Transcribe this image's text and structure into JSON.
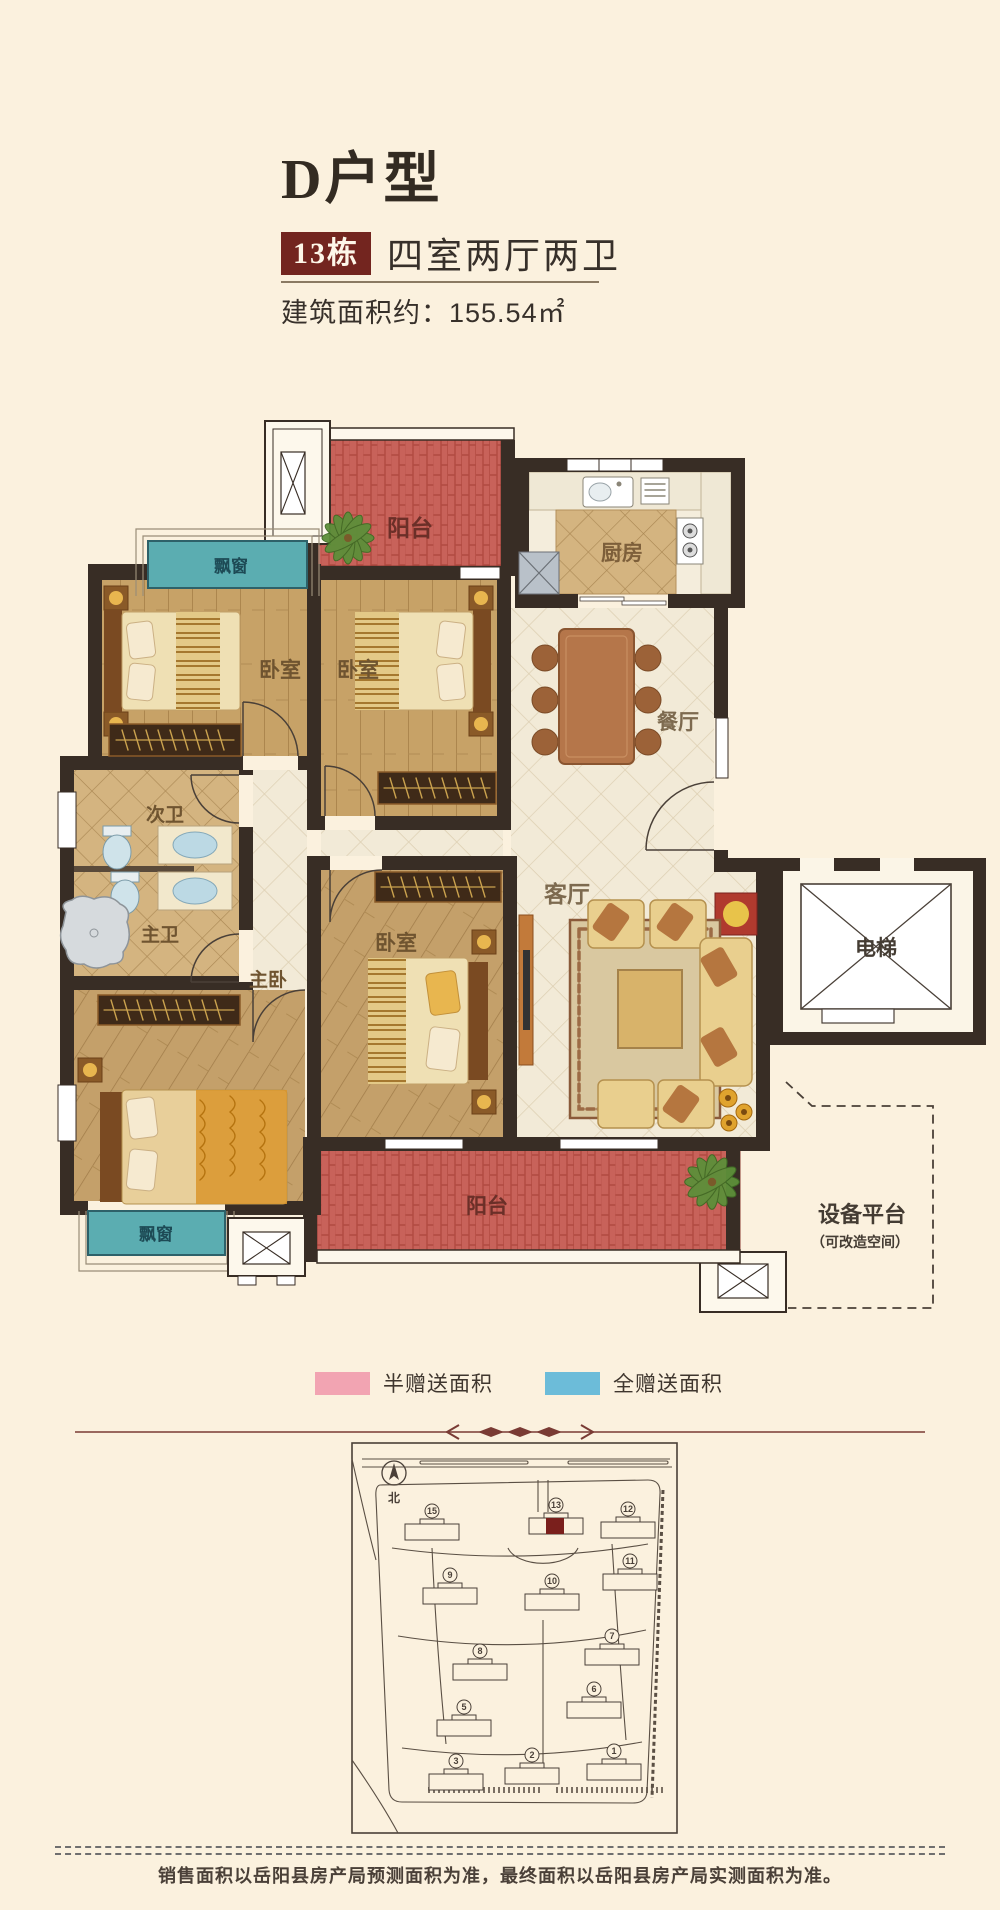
{
  "page": {
    "bg_color": "#fbf1de"
  },
  "header": {
    "title": "D户型",
    "badge": "13栋",
    "subtitle": "四室两厅两卫",
    "area": "建筑面积约：155.54㎡",
    "badge_color": "#73251f"
  },
  "floorplan": {
    "labels": {
      "balcony_top": "阳台",
      "kitchen": "厨房",
      "bedroom1": "卧室",
      "bedroom2": "卧室",
      "dining": "餐厅",
      "bath2": "次卫",
      "bath1": "主卫",
      "master": "主卧",
      "bedroom3": "卧室",
      "living": "客厅",
      "elevator": "电梯",
      "bay_top": "飘窗",
      "bay_bottom": "飘窗",
      "balcony_bottom": "阳台",
      "equipment": "设备平台",
      "equipment_note": "（可改造空间）"
    },
    "colors": {
      "wall": "#382d25",
      "balcony_red": "#c8625a",
      "bay_teal": "#5badb1",
      "wood": "#c7a267",
      "tile_tan": "#d4b480",
      "tile_cream": "#f2ead7"
    }
  },
  "legend": {
    "items": [
      {
        "label": "半赠送面积",
        "color": "#f2a4b2"
      },
      {
        "label": "全赠送面积",
        "color": "#6cbcd9"
      }
    ]
  },
  "siteplan": {
    "north": "北",
    "buildings": [
      {
        "num": "15",
        "x": 432,
        "y": 1532
      },
      {
        "num": "13",
        "x": 556,
        "y": 1526,
        "highlight": true
      },
      {
        "num": "12",
        "x": 628,
        "y": 1530
      },
      {
        "num": "9",
        "x": 450,
        "y": 1596
      },
      {
        "num": "10",
        "x": 552,
        "y": 1602
      },
      {
        "num": "11",
        "x": 630,
        "y": 1582
      },
      {
        "num": "8",
        "x": 480,
        "y": 1672
      },
      {
        "num": "7",
        "x": 612,
        "y": 1657
      },
      {
        "num": "5",
        "x": 464,
        "y": 1728
      },
      {
        "num": "6",
        "x": 594,
        "y": 1710
      },
      {
        "num": "3",
        "x": 456,
        "y": 1782
      },
      {
        "num": "2",
        "x": 532,
        "y": 1776
      },
      {
        "num": "1",
        "x": 614,
        "y": 1772
      }
    ]
  },
  "footer": {
    "disclaimer": "销售面积以岳阳县房产局预测面积为准，最终面积以岳阳县房产局实测面积为准。"
  }
}
